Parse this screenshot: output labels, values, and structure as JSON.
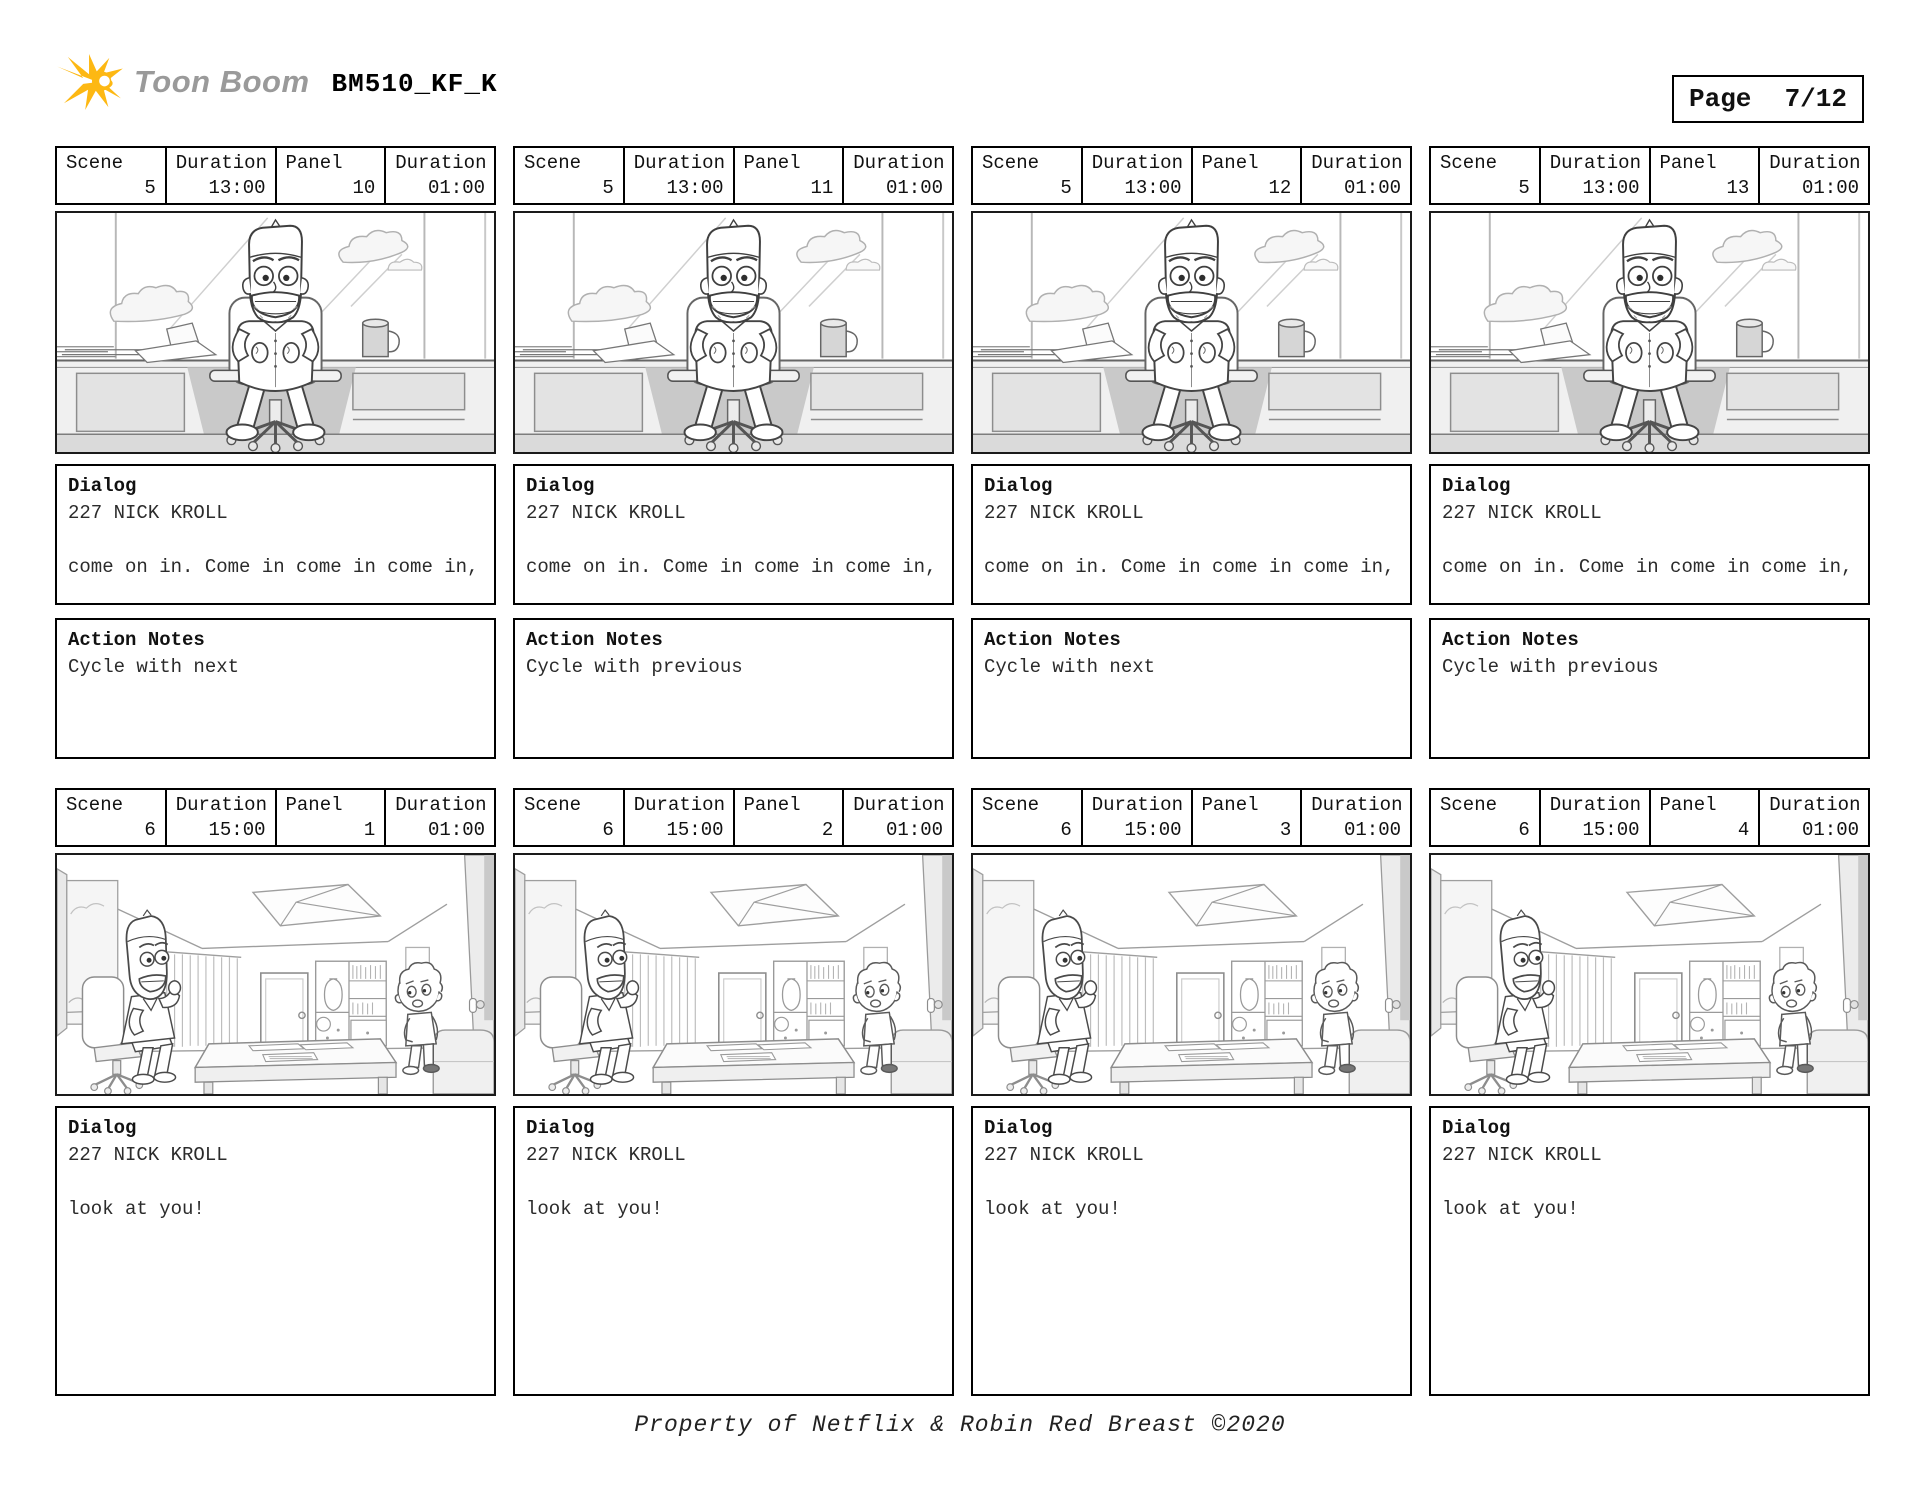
{
  "header": {
    "logo_text": "Toon Boom",
    "title": "BM510_KF_K",
    "page_label": "Page",
    "page_value": "7/12"
  },
  "labels": {
    "scene": "Scene",
    "duration": "Duration",
    "panel": "Panel",
    "dialog": "Dialog",
    "action_notes": "Action Notes"
  },
  "panels": [
    {
      "scene": "5",
      "scene_duration": "13:00",
      "panel": "10",
      "panel_duration": "01:00",
      "dialog": "227 NICK KROLL\n\ncome on in. Come in come in come in,",
      "action_notes": "Cycle with next",
      "artwork": "desk-closeup"
    },
    {
      "scene": "5",
      "scene_duration": "13:00",
      "panel": "11",
      "panel_duration": "01:00",
      "dialog": "227 NICK KROLL\n\ncome on in. Come in come in come in,",
      "action_notes": "Cycle with previous",
      "artwork": "desk-closeup"
    },
    {
      "scene": "5",
      "scene_duration": "13:00",
      "panel": "12",
      "panel_duration": "01:00",
      "dialog": "227 NICK KROLL\n\ncome on in. Come in come in come in,",
      "action_notes": "Cycle with next",
      "artwork": "desk-closeup"
    },
    {
      "scene": "5",
      "scene_duration": "13:00",
      "panel": "13",
      "panel_duration": "01:00",
      "dialog": "227 NICK KROLL\n\ncome on in. Come in come in come in,",
      "action_notes": "Cycle with previous",
      "artwork": "desk-closeup"
    },
    {
      "scene": "6",
      "scene_duration": "15:00",
      "panel": "1",
      "panel_duration": "01:00",
      "dialog": "227 NICK KROLL\n\nlook at you!",
      "action_notes": null,
      "artwork": "office-wide"
    },
    {
      "scene": "6",
      "scene_duration": "15:00",
      "panel": "2",
      "panel_duration": "01:00",
      "dialog": "227 NICK KROLL\n\nlook at you!",
      "action_notes": null,
      "artwork": "office-wide"
    },
    {
      "scene": "6",
      "scene_duration": "15:00",
      "panel": "3",
      "panel_duration": "01:00",
      "dialog": "227 NICK KROLL\n\nlook at you!",
      "action_notes": null,
      "artwork": "office-wide"
    },
    {
      "scene": "6",
      "scene_duration": "15:00",
      "panel": "4",
      "panel_duration": "01:00",
      "dialog": "227 NICK KROLL\n\nlook at you!",
      "action_notes": null,
      "artwork": "office-wide"
    }
  ],
  "footer": {
    "text": "Property of Netflix & Robin Red Breast ©2020"
  },
  "colors": {
    "accent_yellow": "#FDB813",
    "logo_gray": "#9A9A9A",
    "border": "#000000"
  }
}
